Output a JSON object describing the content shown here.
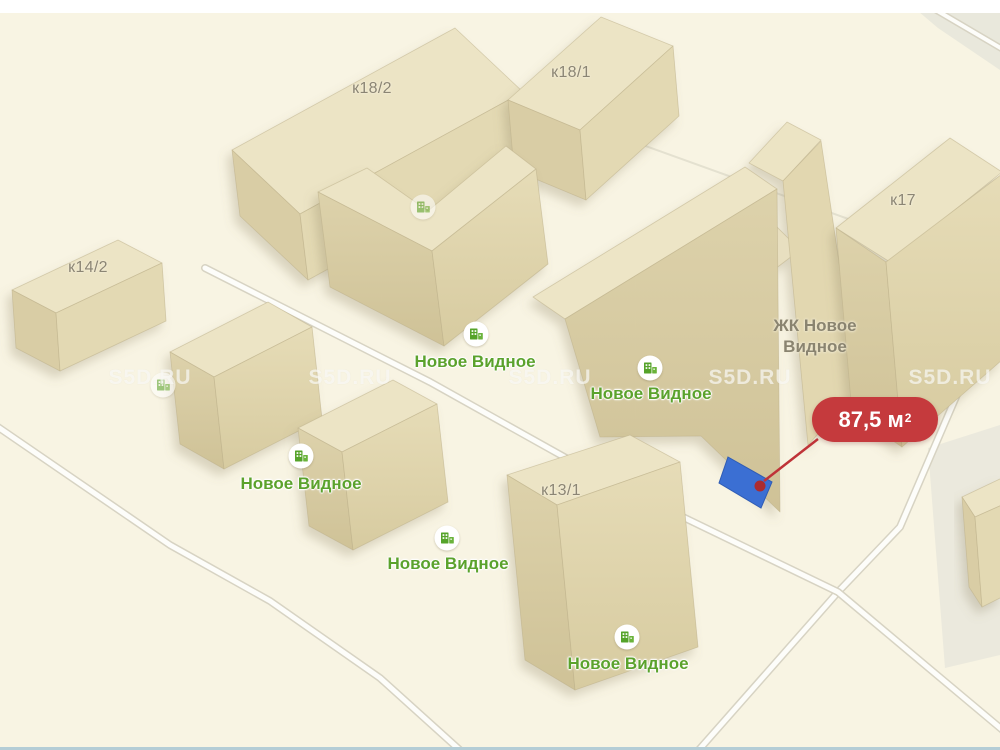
{
  "map": {
    "watermark": {
      "text": "S5D.RU"
    },
    "poi_label": "Новое Видное",
    "complex_label": {
      "line1": "ЖК Новое",
      "line2": "Видное"
    },
    "building_labels": [
      {
        "text": "к18/2"
      },
      {
        "text": "к18/1"
      },
      {
        "text": "к17"
      },
      {
        "text": "к14/2"
      },
      {
        "text": "к13/1"
      }
    ],
    "area_badge": {
      "value": "87,5 м",
      "sup": "2"
    },
    "colors": {
      "badge_red": "#c53a3d",
      "highlight_blue": "#3b6fd3",
      "poi_green": "#5ba22c",
      "building_roof": "#ece4c5",
      "map_background": "#f8f4e3"
    }
  }
}
